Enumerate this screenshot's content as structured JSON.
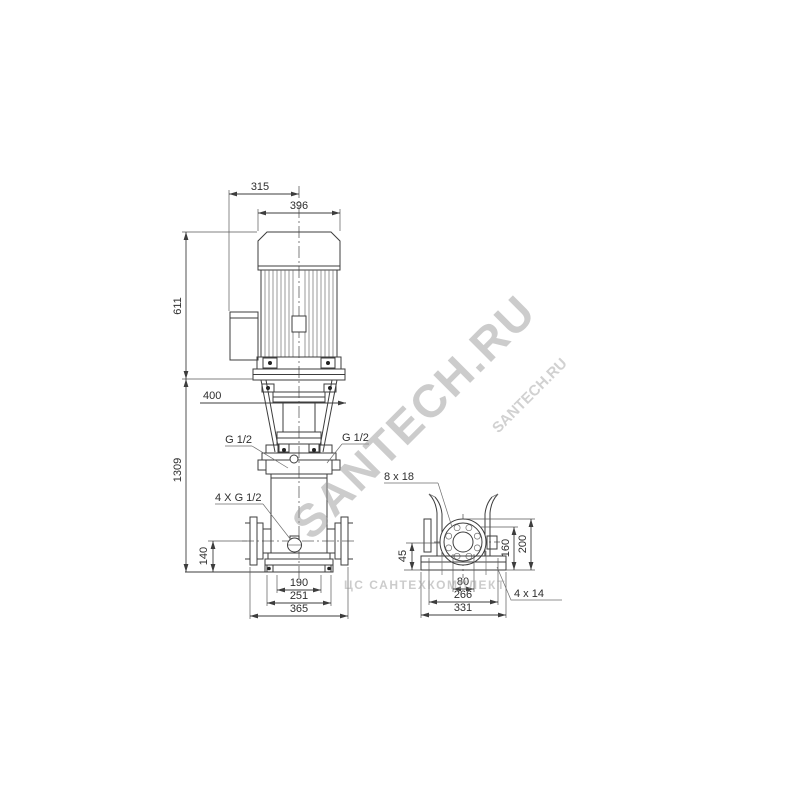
{
  "front_view": {
    "dims": {
      "top_offset": "315",
      "motor_width": "396",
      "motor_height": "611",
      "total_height": "1309",
      "removal_clearance": "400",
      "gauge_port_left": "G 1/2",
      "gauge_port_right": "G 1/2",
      "plug_ports": "4 X G 1/2",
      "port_height": "140",
      "anchor_spacing": "190",
      "base_width": "251",
      "flange_span": "365"
    }
  },
  "base_view": {
    "dims": {
      "flange_bolt_holes": "8 x 18",
      "foot_height": "45",
      "bolt_circle_height": "160",
      "flange_top_height": "200",
      "bolt_pair_spacing": "80",
      "anchor_spacing_long": "266",
      "base_length": "331",
      "base_bolt_holes": "4 x 14"
    }
  },
  "watermarks": {
    "main": "SANTECH.RU",
    "secondary": "SANTECH.RU",
    "bottom": "ЦС САНТЕХКОМПЛЕКТ"
  },
  "colors": {
    "line": "#3d3d3d",
    "watermark": "#9a9a9a",
    "background": "#ffffff"
  }
}
